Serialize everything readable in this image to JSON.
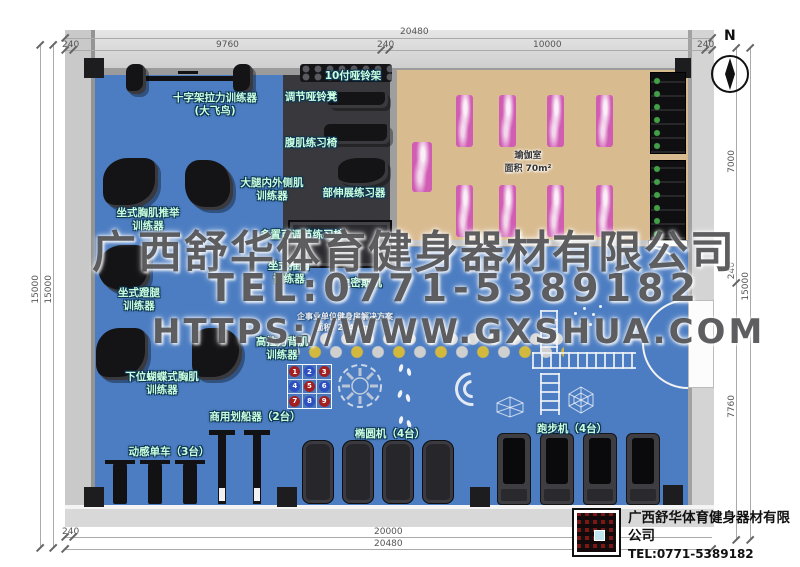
{
  "north_label": "N",
  "dimensions": {
    "top_overall": "20480",
    "top_segments": [
      "240",
      "9760",
      "240",
      "10000",
      "240"
    ],
    "left_outer": "15000",
    "left_inner": "15000",
    "right_overall": "15000",
    "right_segments": [
      "7000",
      "240",
      "7760"
    ],
    "bottom_overall": "20480",
    "bottom_segments": [
      "240",
      "20000"
    ]
  },
  "watermark": {
    "line1": "广西舒华体育健身器材有限公司",
    "line2": "TEL:0771-5389182",
    "line3": "HTTPS://WWW.GXSHUA.COM"
  },
  "plan_note": {
    "line1": "企事业单位健身房解决方案",
    "line2": "面积: 224.4m²"
  },
  "yoga": {
    "name": "瑜伽室",
    "area": "面积 70m²"
  },
  "labels": {
    "crossover": "十字架拉力训练器\n(大飞鸟)",
    "dumbbell_rack": "10付哑铃架",
    "adj_bench": "调节哑铃凳",
    "ab_chair": "腹肌练习椅",
    "thigh": "大腿内外侧肌\n训练器",
    "back_ext": "部伸展练习器",
    "chest_press": "坐式胸肌推举\n训练器",
    "multi_bench": "多置可调节练习椅",
    "shoulder_press": "坐式推肩\n训练器",
    "smith": "史密斯机",
    "leg_press": "坐式蹬腿\n训练器",
    "lat_pull": "高拉力背肌\n训练器",
    "pec_fly": "下位蝴蝶式胸肌\n训练器",
    "rowers": "商用划船器（2台）",
    "bikes": "动感单车（3台）",
    "ellipticals": "椭圆机（4台）",
    "treadmills": "跑步机（4台）"
  },
  "games": {
    "grid_numbers": [
      "1",
      "2",
      "3",
      "4",
      "5",
      "6",
      "7",
      "8",
      "9"
    ]
  },
  "footer": {
    "company": "广西舒华体育健身器材有限公司",
    "tel": "TEL:0771-5389182",
    "url": "HTTPS://WWW.GXSHUA.COM"
  },
  "colors": {
    "floor_blue": "#4c7dc2",
    "dark_tile": "#39393d",
    "wood": "#d9bb90",
    "mat_pink": "#d05cb4",
    "label_green": "#c9ffdf",
    "watermark_gray": "#48484a"
  }
}
